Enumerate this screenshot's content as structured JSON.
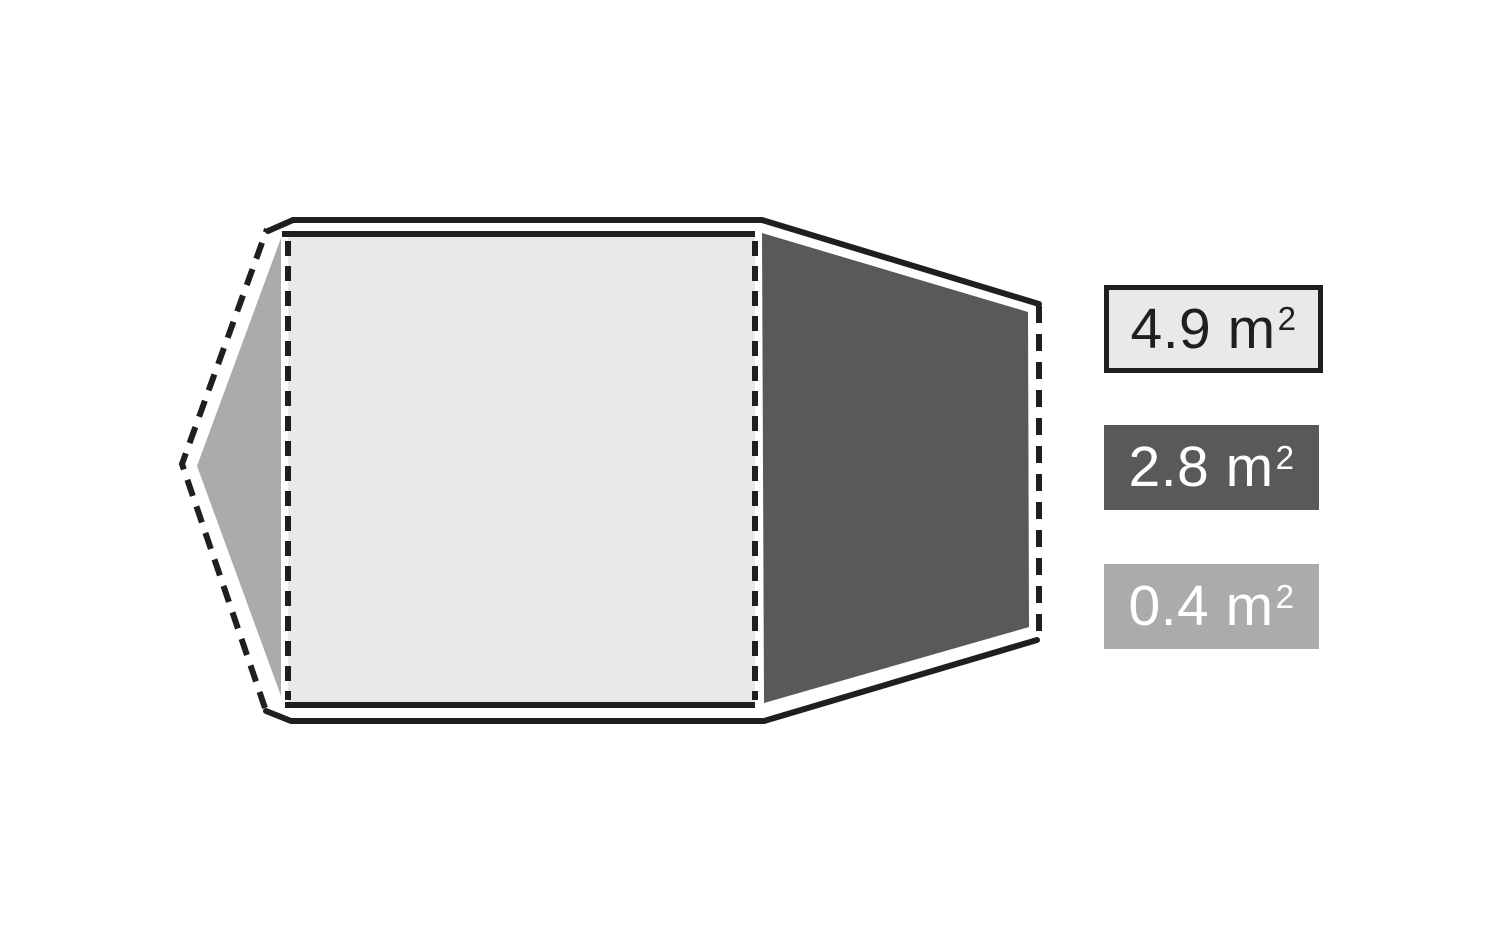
{
  "page": {
    "background": "#ffffff"
  },
  "diagram": {
    "type": "tent-floorplan",
    "outline_color": "#1f1f1f",
    "regions": {
      "inner_tent": {
        "fill": "#e9e9e9"
      },
      "right_vestibule": {
        "fill": "#595959"
      },
      "left_vestibule": {
        "fill": "#ababab"
      }
    }
  },
  "legend": {
    "items": [
      {
        "id": "inner-tent",
        "text": "4.9 m",
        "sup": "2",
        "fill": "#e9e9e9",
        "text_color": "#1f1f1f",
        "border_color": "#1f1f1f"
      },
      {
        "id": "right-vestibule",
        "text": "2.8 m",
        "sup": "2",
        "fill": "#595959",
        "text_color": "#ffffff"
      },
      {
        "id": "left-vestibule",
        "text": "0.4 m",
        "sup": "2",
        "fill": "#ababab",
        "text_color": "#ffffff"
      }
    ]
  }
}
